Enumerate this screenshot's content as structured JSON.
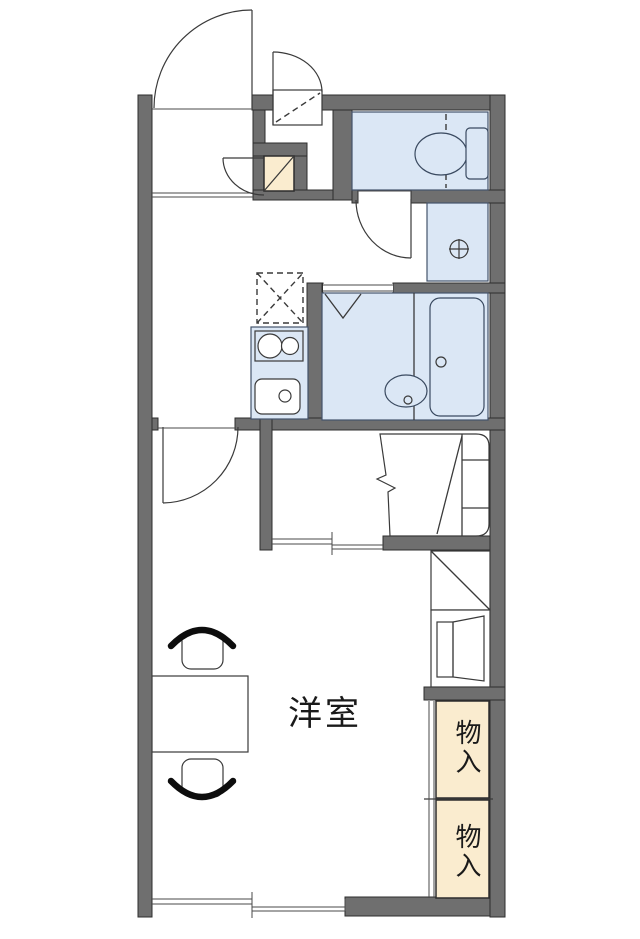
{
  "plan_type": "apartment-floorplan",
  "labels": {
    "main_room": "洋室",
    "storage_upper": "物入",
    "storage_lower": "物入"
  },
  "colors": {
    "background": "#ffffff",
    "wall_fill": "#6f6f6f",
    "wall_outline": "#2d2d2d",
    "fixture_blue": "#dbe7f5",
    "fixture_outline": "#44536b",
    "storage_cream": "#faeccf",
    "line": "#3a3a3a",
    "chair_back": "#0d0d0d",
    "text": "#1a1a1a"
  },
  "fixtures": {
    "entrance_door": "swing-door-icon",
    "exterior_closet_door": "swing-door-icon",
    "shoe_cabinet": "diagonal-box-icon",
    "toilet": "toilet-icon",
    "washer_pan": "washer-pan-icon",
    "bathtub": "bathtub-icon",
    "washbasin": "basin-icon",
    "stove": "two-burner-icon",
    "kitchen_sink": "sink-icon",
    "refrigerator_space": "dashed-x-box-icon",
    "bed": "bed-icon",
    "bedroom_sliding_door": "sliding-door-icon",
    "balcony_window": "sliding-window-icon",
    "table": "table-icon",
    "chairs": "chair-icon"
  }
}
